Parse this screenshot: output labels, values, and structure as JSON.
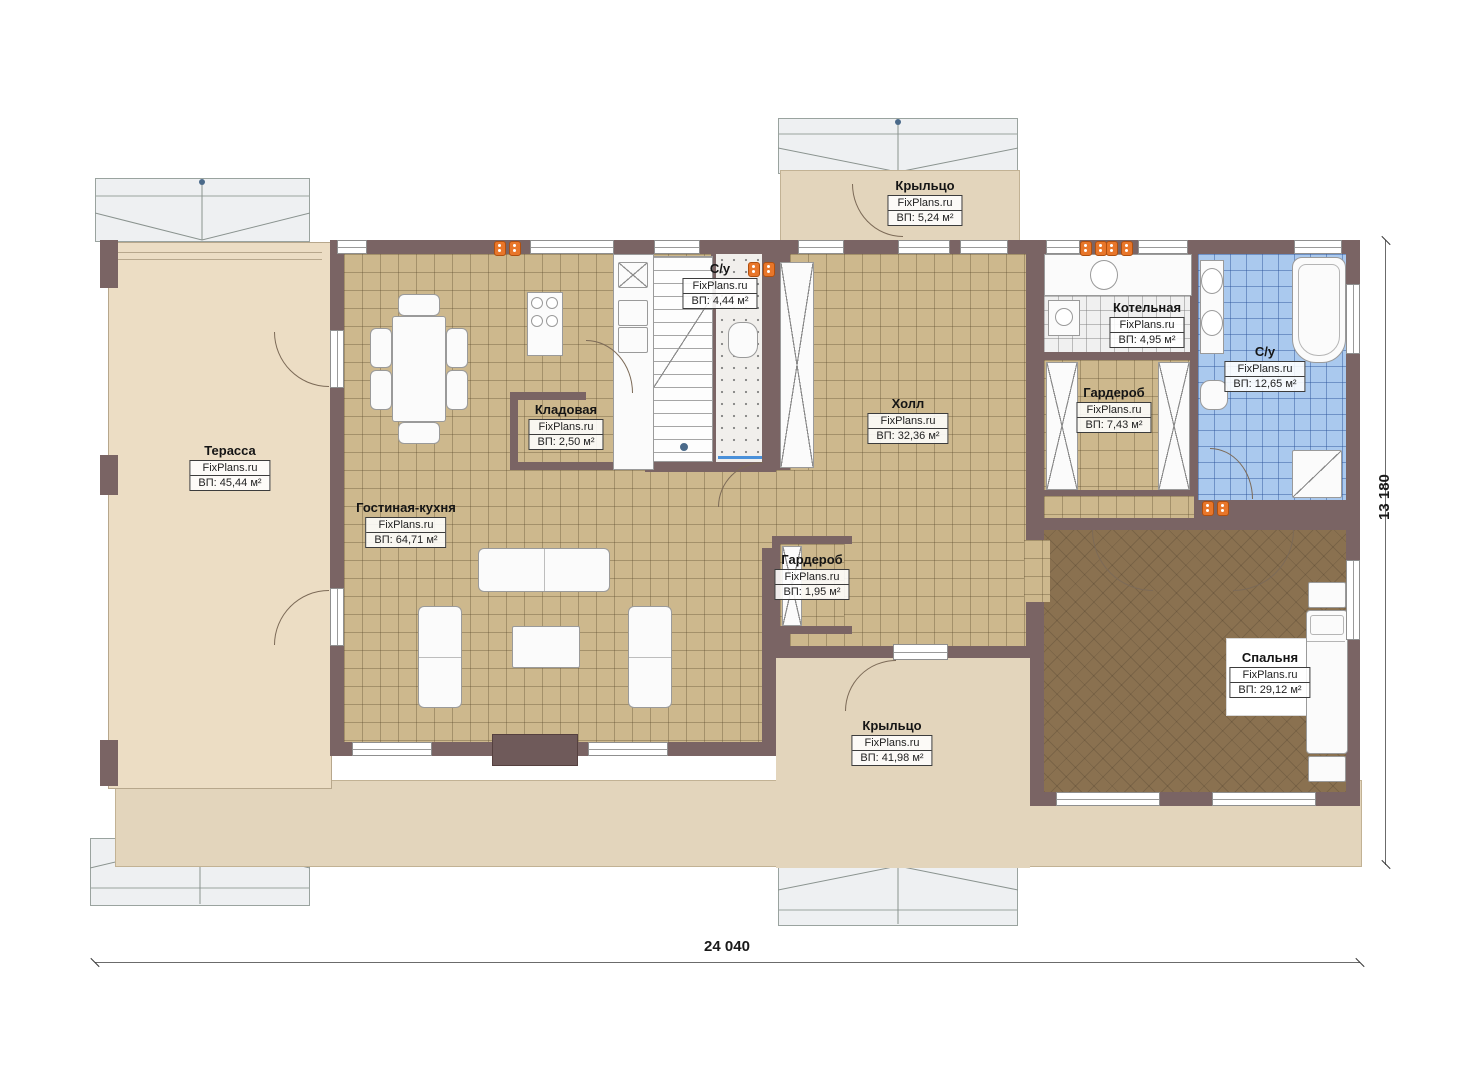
{
  "rooms": [
    {
      "id": "terrace",
      "name": "Терасса",
      "brand": "FixPlans.ru",
      "area": "ВП: 45,44 м²"
    },
    {
      "id": "porch-top",
      "name": "Крыльцо",
      "brand": "FixPlans.ru",
      "area": "ВП: 5,24 м²"
    },
    {
      "id": "wc-small",
      "name": "С/у",
      "brand": "FixPlans.ru",
      "area": "ВП: 4,44 м²"
    },
    {
      "id": "pantry",
      "name": "Кладовая",
      "brand": "FixPlans.ru",
      "area": "ВП: 2,50 м²"
    },
    {
      "id": "living-kitchen",
      "name": "Гостиная-кухня",
      "brand": "FixPlans.ru",
      "area": "ВП: 64,71 м²"
    },
    {
      "id": "hall",
      "name": "Холл",
      "brand": "FixPlans.ru",
      "area": "ВП: 32,36 м²"
    },
    {
      "id": "boiler",
      "name": "Котельная",
      "brand": "FixPlans.ru",
      "area": "ВП: 4,95 м²"
    },
    {
      "id": "wardrobe-main",
      "name": "Гардероб",
      "brand": "FixPlans.ru",
      "area": "ВП: 7,43 м²"
    },
    {
      "id": "wc-big",
      "name": "С/у",
      "brand": "FixPlans.ru",
      "area": "ВП: 12,65 м²"
    },
    {
      "id": "wardrobe-small",
      "name": "Гардероб",
      "brand": "FixPlans.ru",
      "area": "ВП: 1,95 м²"
    },
    {
      "id": "porch-bottom",
      "name": "Крыльцо",
      "brand": "FixPlans.ru",
      "area": "ВП: 41,98 м²"
    },
    {
      "id": "bedroom",
      "name": "Спальня",
      "brand": "FixPlans.ru",
      "area": "ВП: 29,12 м²"
    }
  ],
  "dimensions": {
    "total_width": "24 040",
    "total_height": "13 180"
  },
  "colors": {
    "wall": "#7a6464",
    "tile_tan": "#cdb88d",
    "tile_blue": "#aac9ee",
    "floor_bedroom": "#8a7150",
    "beige": "#e3d5bc",
    "terrace": "#ecddc4",
    "vent_accent": "#e8762a"
  }
}
